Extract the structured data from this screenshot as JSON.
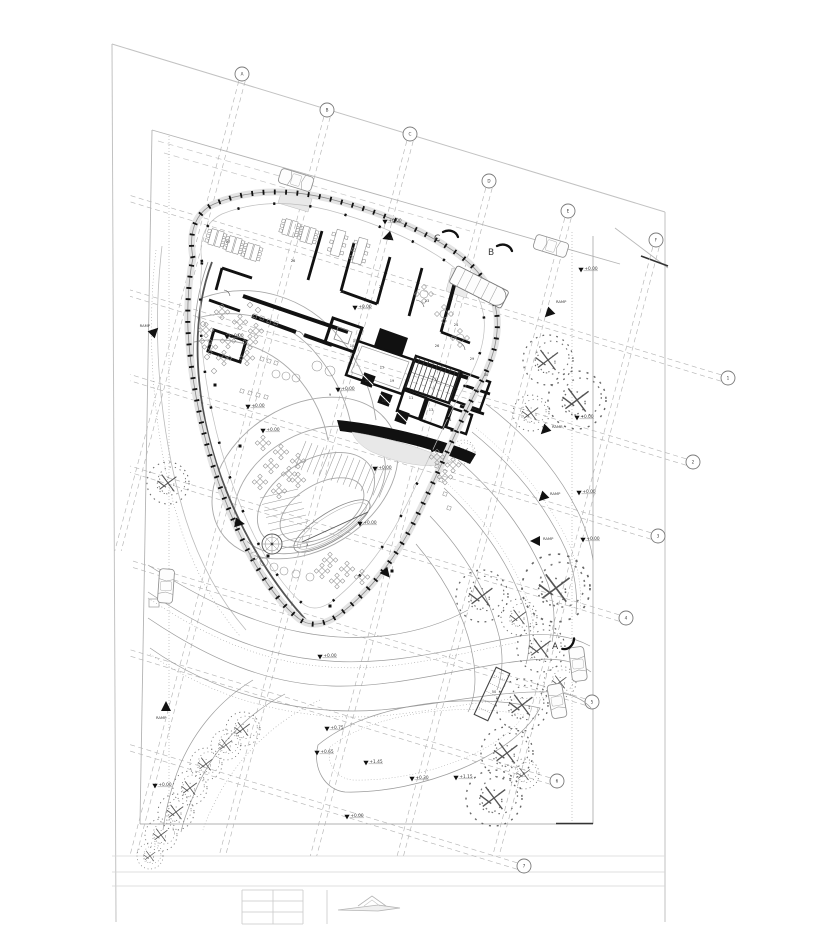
{
  "document": {
    "sheet_type": "architectural site plan",
    "visible_title_text": ""
  },
  "colors": {
    "paper": "#ffffff",
    "boundary_light": "#c2c2c2",
    "fence_gray": "#b4b4b4",
    "grid_dash": "#b5b5b5",
    "wall_black": "#111111",
    "curve_gray": "#9b9b9b",
    "tree_gray": "#666666",
    "facade_band": "#e4e4e4",
    "label_dark": "#333333"
  },
  "plan": {
    "grid": {
      "top_axes": [
        {
          "x": 242,
          "y": 74,
          "label": "A"
        },
        {
          "x": 327,
          "y": 110,
          "label": "B"
        },
        {
          "x": 410,
          "y": 134,
          "label": "C"
        },
        {
          "x": 489,
          "y": 181,
          "label": "D"
        },
        {
          "x": 568,
          "y": 211,
          "label": "E"
        },
        {
          "x": 656,
          "y": 240,
          "label": "F"
        }
      ],
      "side_axes": [
        {
          "x": 728,
          "y": 378,
          "label": "1"
        },
        {
          "x": 693,
          "y": 462,
          "label": "2"
        },
        {
          "x": 658,
          "y": 536,
          "label": "3"
        },
        {
          "x": 626,
          "y": 618,
          "label": "4"
        },
        {
          "x": 592,
          "y": 702,
          "label": "5"
        },
        {
          "x": 557,
          "y": 781,
          "label": "6"
        },
        {
          "x": 524,
          "y": 866,
          "label": "7"
        }
      ]
    },
    "elevation_markers": [
      [
        385,
        222,
        "+0.00"
      ],
      [
        581,
        270,
        "+0.00"
      ],
      [
        355,
        308,
        "+0.00"
      ],
      [
        227,
        337,
        "+0.00"
      ],
      [
        248,
        407,
        "+0.00"
      ],
      [
        263,
        431,
        "+0.00"
      ],
      [
        338,
        390,
        "+0.00"
      ],
      [
        375,
        469,
        "+0.00"
      ],
      [
        360,
        524,
        "+0.00"
      ],
      [
        577,
        418,
        "+0.00"
      ],
      [
        579,
        493,
        "+0.00"
      ],
      [
        583,
        540,
        "+0.00"
      ],
      [
        320,
        657,
        "+0.00"
      ],
      [
        327,
        729,
        "+0.75"
      ],
      [
        317,
        753,
        "+0.65"
      ],
      [
        366,
        763,
        "+1.45"
      ],
      [
        412,
        779,
        "+0.30"
      ],
      [
        456,
        778,
        "+1.15"
      ],
      [
        347,
        817,
        "+0.00"
      ],
      [
        155,
        786,
        "+0.00"
      ]
    ],
    "ramp_markers": [
      {
        "x": 549,
        "y": 313,
        "rot": 225,
        "lx": 556,
        "ly": 303,
        "label": "RAMP",
        "anchor": "start"
      },
      {
        "x": 545,
        "y": 430,
        "rot": 225,
        "lx": 552,
        "ly": 428,
        "label": "RAMP",
        "anchor": "start"
      },
      {
        "x": 543,
        "y": 497,
        "rot": 225,
        "lx": 550,
        "ly": 495,
        "label": "RAMP",
        "anchor": "start"
      },
      {
        "x": 536,
        "y": 541,
        "rot": 270,
        "lx": 543,
        "ly": 540,
        "label": "RAMP",
        "anchor": "start"
      },
      {
        "x": 166,
        "y": 707,
        "rot": 0,
        "lx": 156,
        "ly": 719,
        "label": "RAMP",
        "anchor": "start"
      },
      {
        "x": 154,
        "y": 332,
        "rot": 45,
        "lx": 150,
        "ly": 327,
        "label": "RAMP",
        "anchor": "end"
      }
    ],
    "flow_arrows": [
      {
        "x": 239,
        "y": 523,
        "rot": 100
      },
      {
        "x": 386,
        "y": 573,
        "rot": 140
      },
      {
        "x": 388,
        "y": 237,
        "rot": 250
      }
    ],
    "section_markers": [
      {
        "label": "C",
        "x": 434,
        "y": 241,
        "rot": 0
      },
      {
        "label": "B",
        "x": 488,
        "y": 255,
        "rot": 0
      },
      {
        "label": "A",
        "x": 552,
        "y": 649,
        "rot": 120
      }
    ],
    "rooms": [
      [
        228,
        243,
        "27"
      ],
      [
        293,
        262,
        "26"
      ],
      [
        390,
        240,
        "25"
      ],
      [
        342,
        293,
        "22"
      ],
      [
        381,
        288,
        "21"
      ],
      [
        427,
        302,
        "23"
      ],
      [
        456,
        326,
        "24"
      ],
      [
        437,
        347,
        "26"
      ],
      [
        355,
        342,
        "15"
      ],
      [
        382,
        369,
        "17"
      ],
      [
        367,
        382,
        "18"
      ],
      [
        392,
        382,
        "19"
      ],
      [
        384,
        402,
        "16"
      ],
      [
        411,
        399,
        "11"
      ],
      [
        431,
        411,
        "13"
      ],
      [
        449,
        421,
        "14"
      ],
      [
        472,
        360,
        "29"
      ],
      [
        486,
        376,
        "30"
      ],
      [
        477,
        392,
        "50"
      ],
      [
        352,
        347,
        "10"
      ],
      [
        238,
        336,
        "4"
      ],
      [
        247,
        409,
        "7"
      ],
      [
        330,
        396,
        "9"
      ],
      [
        307,
        546,
        "3"
      ],
      [
        494,
        693,
        "50"
      ]
    ],
    "trees": [
      [
        168,
        483,
        2.1
      ],
      [
        548,
        360,
        2.5
      ],
      [
        577,
        400,
        2.9
      ],
      [
        531,
        413,
        1.8
      ],
      [
        556,
        588,
        3.4
      ],
      [
        482,
        596,
        2.6
      ],
      [
        519,
        617,
        1.8
      ],
      [
        541,
        648,
        2.4
      ],
      [
        560,
        682,
        1.6
      ],
      [
        522,
        705,
        2.6
      ],
      [
        507,
        753,
        2.6
      ],
      [
        494,
        798,
        2.8
      ],
      [
        524,
        774,
        1.5
      ],
      [
        243,
        729,
        1.7
      ],
      [
        226,
        745,
        1.5
      ],
      [
        206,
        764,
        1.6
      ],
      [
        190,
        788,
        1.7
      ],
      [
        176,
        812,
        1.8
      ],
      [
        161,
        835,
        1.6
      ],
      [
        150,
        856,
        1.3
      ],
      [
        463,
        452,
        1.2
      ]
    ],
    "cars": [
      {
        "x": 296,
        "y": 180,
        "rot": 17,
        "type": "car"
      },
      {
        "x": 551,
        "y": 246,
        "rot": 17,
        "type": "car"
      },
      {
        "x": 479,
        "y": 287,
        "rot": 27,
        "type": "bus"
      },
      {
        "x": 166,
        "y": 586,
        "rot": 94,
        "type": "car"
      },
      {
        "x": 578,
        "y": 664,
        "rot": 83,
        "type": "car"
      },
      {
        "x": 557,
        "y": 701,
        "rot": 80,
        "type": "car"
      }
    ],
    "furniture": {
      "desks": [
        [
          216,
          238
        ],
        [
          234,
          245
        ],
        [
          252,
          252
        ],
        [
          290,
          228
        ],
        [
          308,
          235
        ]
      ],
      "meeting_tables": [
        [
          338,
          243
        ],
        [
          360,
          251
        ]
      ],
      "round_tables": [
        [
          424,
          294
        ],
        [
          444,
          314
        ],
        [
          460,
          338
        ]
      ],
      "tables": [
        [
          222,
          312
        ],
        [
          240,
          322
        ],
        [
          256,
          331
        ],
        [
          250,
          342
        ],
        [
          228,
          341
        ],
        [
          224,
          358
        ],
        [
          247,
          358
        ],
        [
          206,
          330
        ],
        [
          210,
          347
        ],
        [
          263,
          443
        ],
        [
          281,
          452
        ],
        [
          298,
          461
        ],
        [
          271,
          466
        ],
        [
          289,
          474
        ],
        [
          260,
          482
        ],
        [
          279,
          491
        ],
        [
          298,
          480
        ],
        [
          330,
          560
        ],
        [
          347,
          569
        ],
        [
          362,
          577
        ],
        [
          337,
          581
        ],
        [
          322,
          571
        ],
        [
          437,
          457
        ],
        [
          453,
          465
        ],
        [
          445,
          477
        ]
      ],
      "diamonds": [
        [
          203,
          324
        ],
        [
          202,
          341
        ],
        [
          207,
          357
        ],
        [
          214,
          371
        ],
        [
          250,
          305
        ],
        [
          258,
          310
        ]
      ],
      "chairs": [
        [
          255,
          316
        ],
        [
          262,
          318
        ],
        [
          269,
          321
        ],
        [
          276,
          323
        ],
        [
          262,
          359
        ],
        [
          269,
          361
        ],
        [
          276,
          363
        ],
        [
          242,
          391
        ],
        [
          250,
          393
        ],
        [
          258,
          395
        ],
        [
          266,
          397
        ],
        [
          437,
          466
        ],
        [
          441,
          480
        ],
        [
          445,
          494
        ],
        [
          449,
          508
        ]
      ],
      "circles": [
        [
          276,
          374,
          4
        ],
        [
          286,
          376,
          4
        ],
        [
          296,
          378,
          4
        ],
        [
          317,
          366,
          5
        ],
        [
          330,
          371,
          5
        ],
        [
          254,
          556,
          4
        ],
        [
          264,
          562,
          4
        ],
        [
          274,
          567,
          4
        ],
        [
          284,
          571,
          4
        ],
        [
          296,
          574,
          4
        ],
        [
          310,
          577,
          4
        ]
      ],
      "columns": [
        [
          215,
          385
        ],
        [
          240,
          446
        ],
        [
          268,
          556
        ],
        [
          330,
          606
        ],
        [
          392,
          571
        ],
        [
          452,
          430
        ]
      ]
    }
  }
}
